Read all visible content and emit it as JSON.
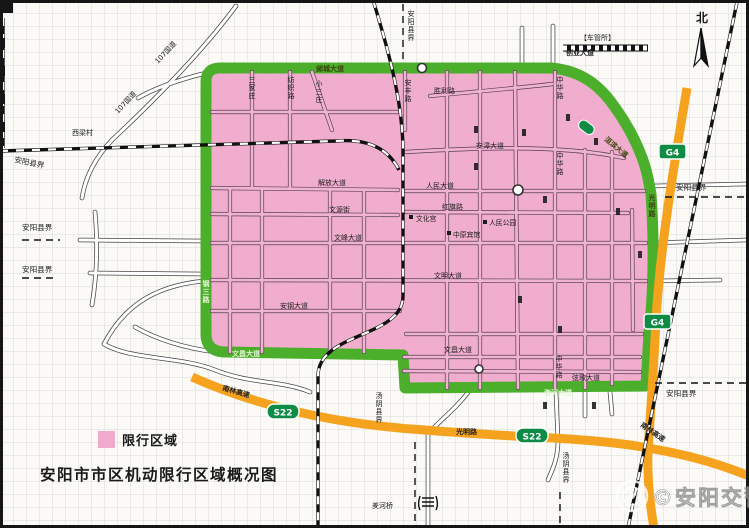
{
  "header": {
    "title": "安阳市市区机动限行区域概况图"
  },
  "legend": {
    "restricted": "限行区域"
  },
  "compass": {
    "north": "北"
  },
  "watermark": {
    "text": "©安阳交警"
  },
  "badges": {
    "g4": "G4",
    "s22": "S22"
  },
  "colors": {
    "restricted_pink": "#F0AACB",
    "zone_border_green": "#4CAF2B",
    "highway_orange": "#F5A31F",
    "route_badge_green": "#0E8C46",
    "grid_gray": "#D9D9D9"
  },
  "roads": {
    "labels": {
      "guodao107": "107国道",
      "xiliangcun": "西梁村",
      "anyang_boundary": "安阳县界",
      "tangyin_boundary": "汤阴县界",
      "yecheng": "邺城大道",
      "anfeng": "安丰路",
      "shengli": "胜利路",
      "zhonghua": "中华路",
      "cheguansuo": "【车管所】",
      "chuangye": "创业大道",
      "sanjiazhuang": "三家庄",
      "fangzhi": "纺织路",
      "xiaosanzhuang": "小三庄",
      "huanbin": "洹滨大道",
      "guangming": "光明路",
      "gangsan": "钢三路",
      "jiefang": "解放大道",
      "wenyuan": "文源街",
      "wenfeng": "文峰大道",
      "wenming": "文明大道",
      "angang": "安钢大道",
      "anzhang": "安漳大道",
      "renmin_dadao": "人民大道",
      "hongqi": "红旗路",
      "wenchang": "文昌大道",
      "xiange": "弦歌大道",
      "haihe": "海河大道",
      "nanlin": "南林高速",
      "youhe_bridge": "羑河桥"
    }
  },
  "pois": {
    "wenhuagong": "文化宫",
    "renmin_gongyuan": "人民公园",
    "zhongyuan_binguan": "中原宾馆"
  }
}
